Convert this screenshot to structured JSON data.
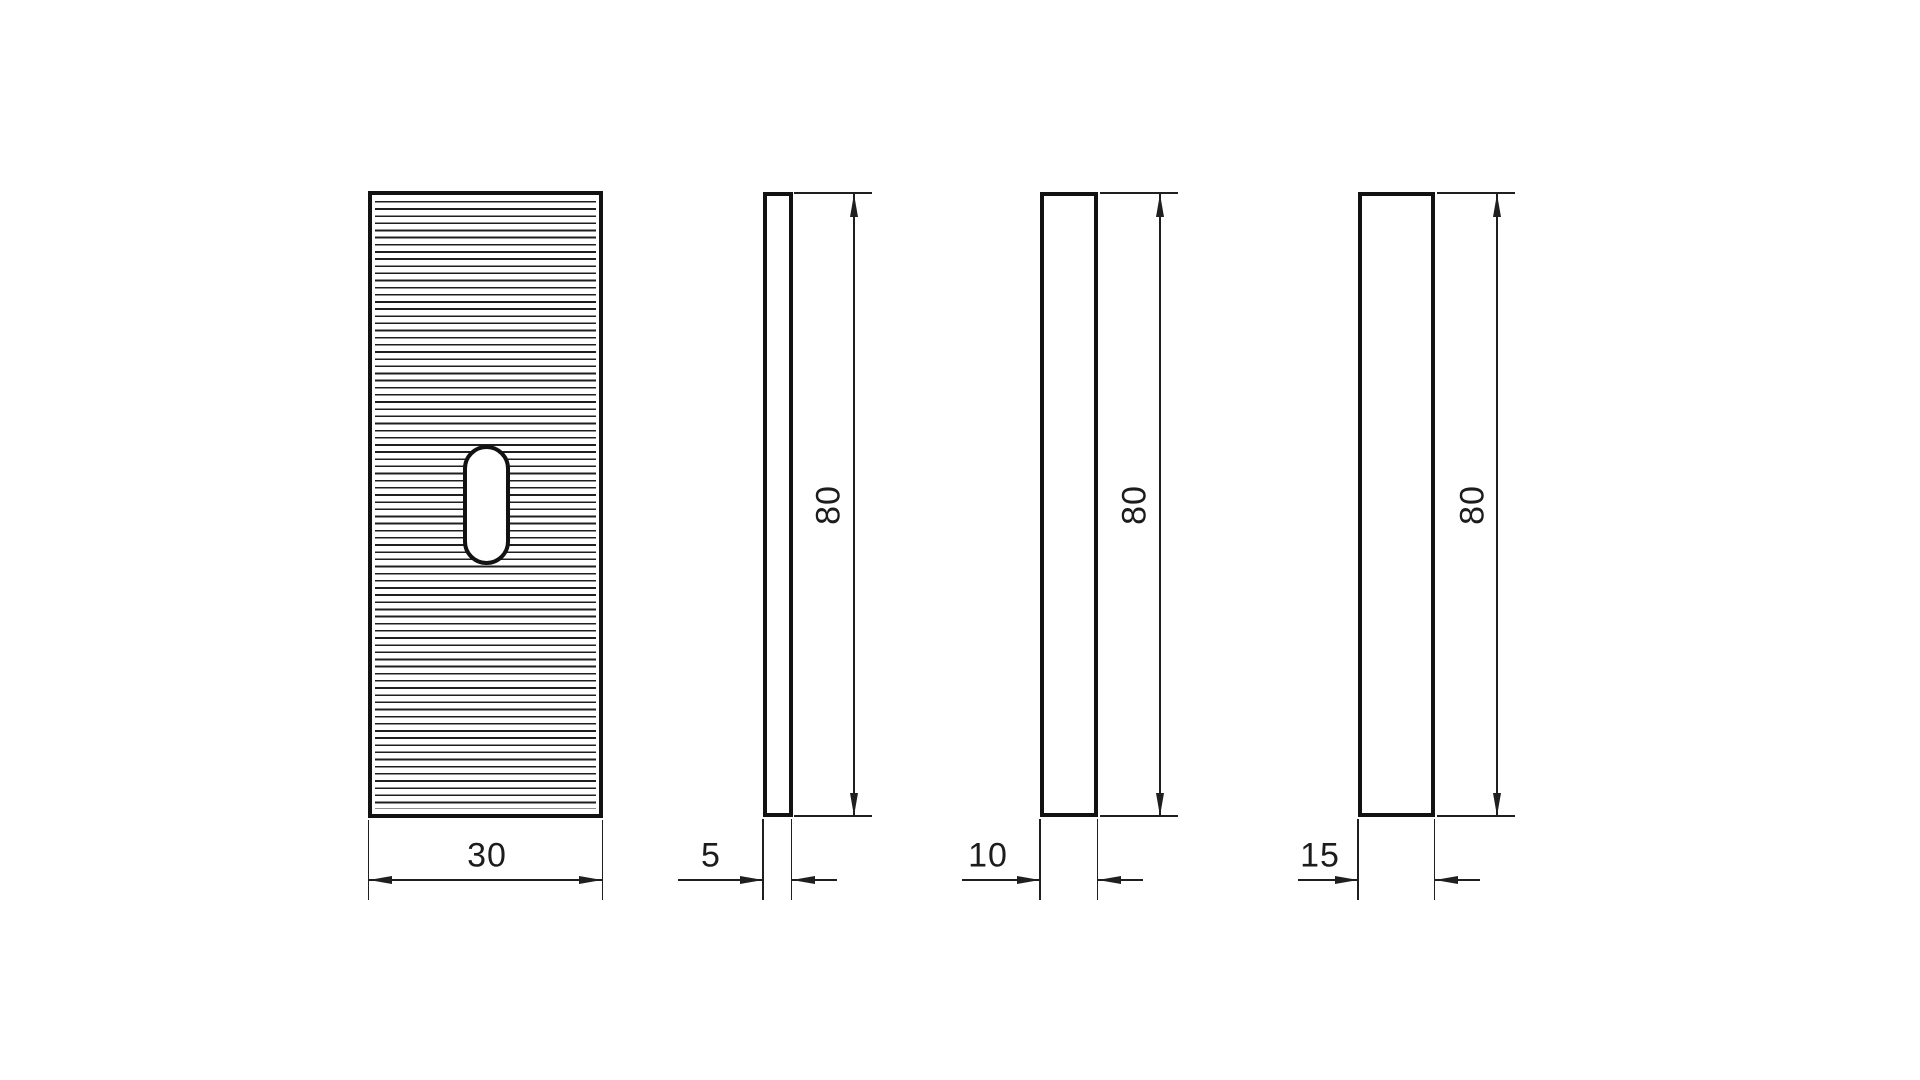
{
  "drawing": {
    "background_color": "#ffffff",
    "outline_color": "#121212",
    "line_color": "#1f1f1f",
    "text_color": "#1c1c1c",
    "front_pattern": "horizontal-serration-lines",
    "front_feature": "rounded-slot-hole",
    "views": [
      {
        "width_label": "30"
      },
      {
        "width_label": "5",
        "height_label": "80"
      },
      {
        "width_label": "10",
        "height_label": "80"
      },
      {
        "width_label": "15",
        "height_label": "80"
      }
    ]
  }
}
